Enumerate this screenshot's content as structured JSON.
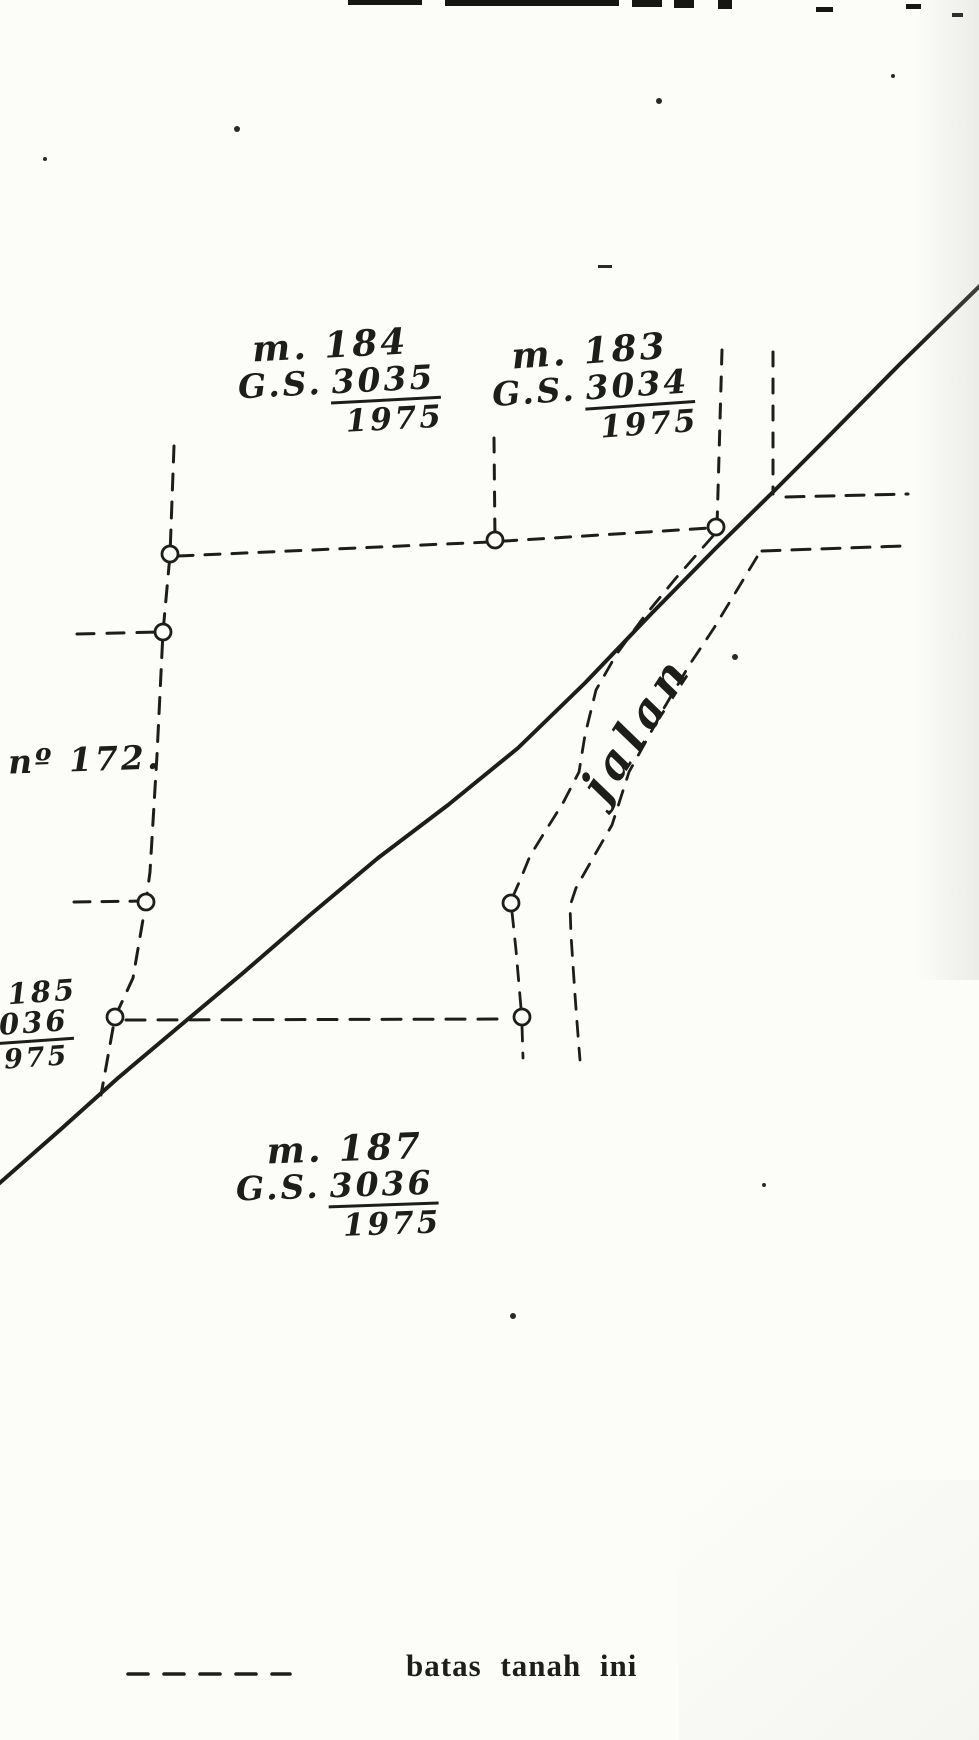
{
  "map": {
    "paper_color": "#fcfcf9",
    "ink_color": "#1d1d1b",
    "parcels": {
      "m184": {
        "name": "m. 184",
        "gs_prefix": "G.S.",
        "gs_number": "3035",
        "gs_year": "1975"
      },
      "m183": {
        "name": "m. 183",
        "gs_prefix": "G.S.",
        "gs_number": "3034",
        "gs_year": "1975"
      },
      "n172": {
        "name": "nº 172."
      },
      "m185": {
        "name": "185",
        "gs_number": "3036",
        "gs_year": "1975"
      },
      "m187": {
        "name": "m. 187",
        "gs_prefix": "G.S.",
        "gs_number": "3036",
        "gs_year": "1975"
      }
    },
    "road_label": "jalan",
    "legend": {
      "label": "batas tanah ini",
      "symbol": "dashed-line"
    }
  }
}
